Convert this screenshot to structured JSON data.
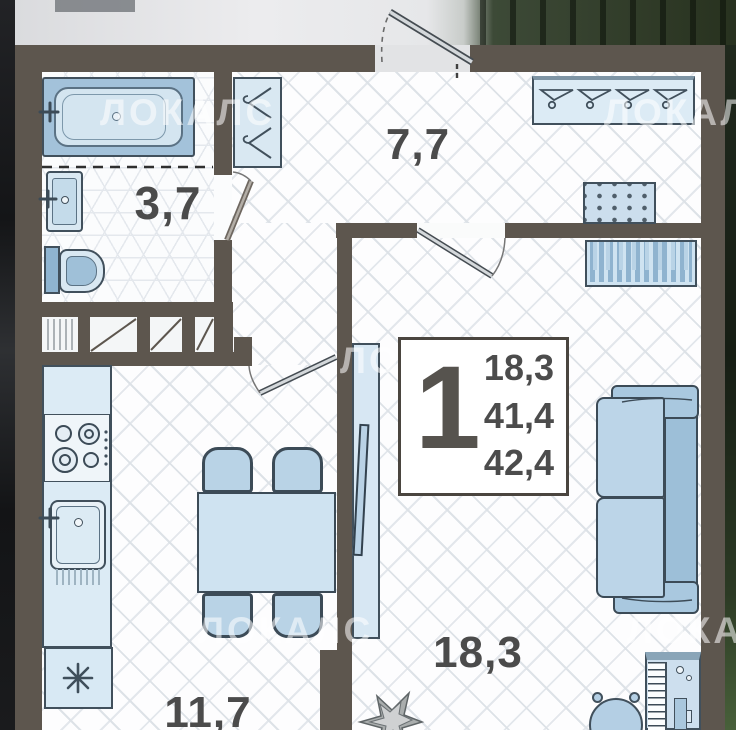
{
  "title": "1-room apartment floor plan",
  "unit_info": {
    "rooms_count": "1",
    "living_area": "18,3",
    "area_no_balcony": "41,4",
    "total_area": "42,4"
  },
  "room_labels": {
    "bathroom": "3,7",
    "hallway": "7,7",
    "kitchen": "11,7",
    "living_room": "18,3"
  },
  "watermark": {
    "text": "ЛОКАЛС"
  },
  "colors": {
    "wall": "#5d564e",
    "furniture_fill": "#d7e7f3",
    "furniture_accent": "#9dbfd8",
    "outline": "#41505c",
    "floor_line": "#dfe4e9",
    "label_text": "#4b4b4b"
  },
  "icons": [
    "bathtub",
    "washbasin",
    "toilet",
    "hanger",
    "shoe-cabinet",
    "wardrobe",
    "entrance-door",
    "stove",
    "kitchen-sink",
    "fridge-snowflake",
    "dining-table",
    "chair",
    "tv-stand",
    "sofa",
    "piano",
    "stool",
    "plant"
  ]
}
